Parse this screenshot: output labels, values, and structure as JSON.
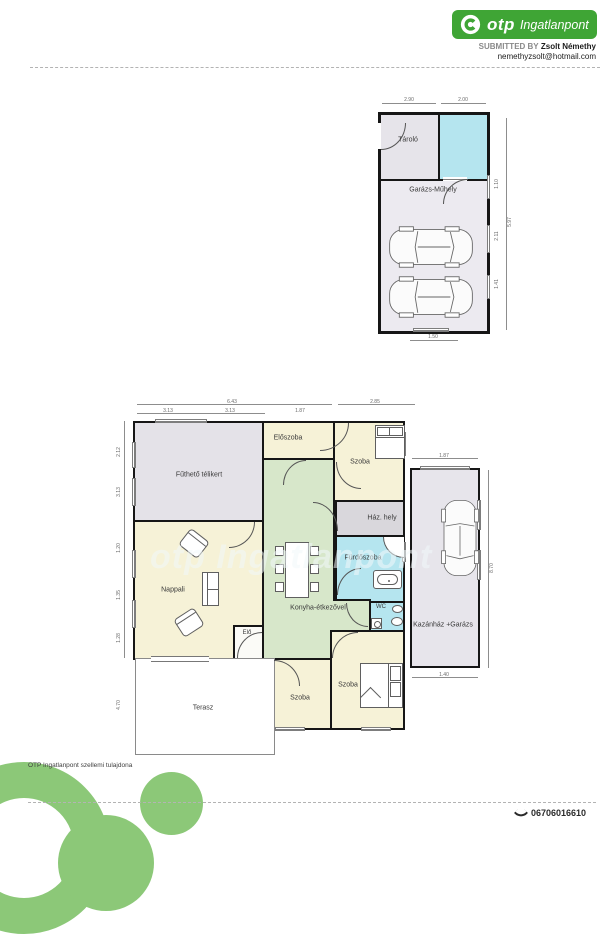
{
  "header": {
    "brand_otp": "otp",
    "brand_suffix": "Ingatlanpont",
    "submitted_by_label": "SUBMITTED BY",
    "submitted_by_name": "Zsolt Némethy",
    "email": "nemethyzsolt@hotmail.com"
  },
  "watermark": "otp Ingatlanpont",
  "garage_plan": {
    "labels": {
      "storage": "Tároló",
      "workshop": "Garázs-Műhely"
    },
    "dims": {
      "top1": "2.90",
      "top2": "2.00",
      "bottom": "1.50",
      "r1": "1.10",
      "r2": "2.11",
      "r3": "1.41",
      "r_total": "5.97"
    }
  },
  "main_plan": {
    "labels": {
      "winter_garden": "Fűthető télikert",
      "hallway": "Előszoba",
      "room_top": "Szoba",
      "utility": "Ház. hely",
      "bathroom": "Fürdőszoba",
      "wc": "WC",
      "kitchen": "Konyha-étkezővel",
      "living": "Nappali",
      "entry": "Elő",
      "boiler_garage": "Kazánház +Garázs",
      "room_bottom_left": "Szoba",
      "room_bottom_right": "Szoba",
      "terrace": "Terasz"
    },
    "dims": {
      "top_total": "6.43",
      "top_sub1": "3.13",
      "top_sub2": "3.13",
      "top_sub3": "1.87",
      "top_right": "2.85",
      "kaz_top": "1.87",
      "kaz_right": "8.70",
      "kaz_bottom": "1.40",
      "left1": "2.12",
      "left2": "3.13",
      "left3": "1.20",
      "left4": "1.35",
      "left5": "1.28",
      "terrace_left": "4.70"
    }
  },
  "footer": {
    "copyright": "OTP Ingatlanpont szellemi tulajdona",
    "phone": "06706016610"
  },
  "colors": {
    "brand_green": "#3fa535",
    "logo_light_green": "#8cc878",
    "room_yellow": "#f6f2d7",
    "room_green": "#d7e7ca",
    "room_cyan": "#b5e5ef",
    "room_gray": "#e4e2e8",
    "wall": "#161616"
  }
}
